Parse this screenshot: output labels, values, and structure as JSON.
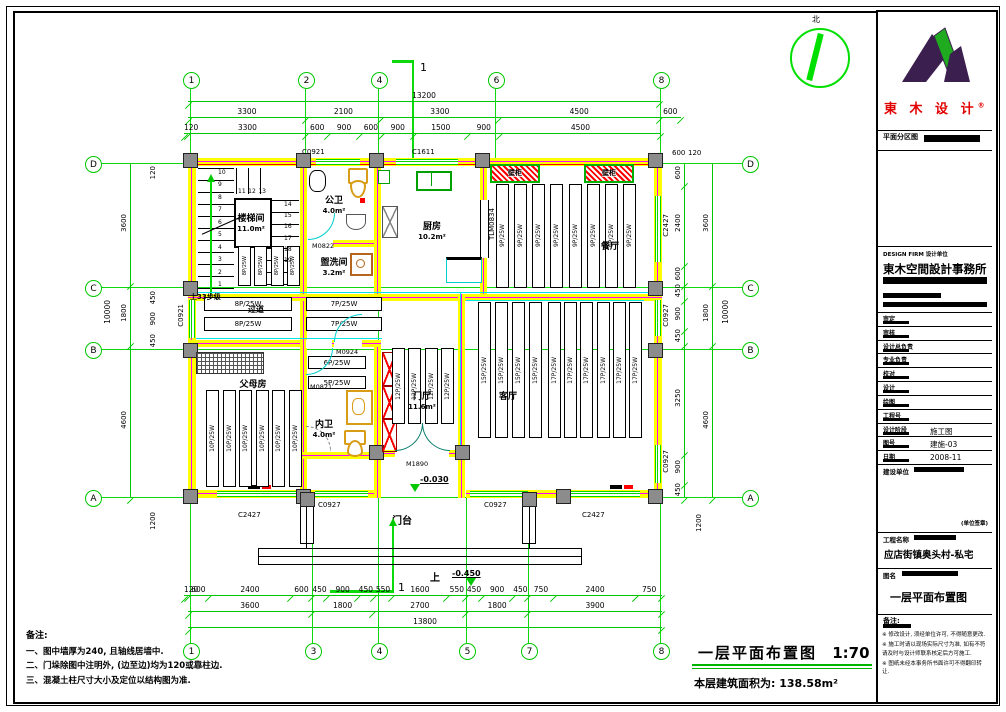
{
  "compass": {
    "north": "北"
  },
  "section": {
    "top": "1",
    "bottom": "1",
    "up": "上"
  },
  "grid": {
    "top": [
      "1",
      "2",
      "4",
      "6",
      "8"
    ],
    "bottom": [
      "1",
      "3",
      "4",
      "5",
      "7",
      "8"
    ],
    "left": [
      "D",
      "C",
      "B",
      "A"
    ],
    "right": [
      "D",
      "C",
      "B",
      "A"
    ]
  },
  "dims": {
    "top_total": "13200",
    "top_row2": [
      "3300",
      "2100",
      "3300",
      "4500",
      "600"
    ],
    "top_row3": [
      "120",
      "3300",
      "600",
      "900",
      "600",
      "900",
      "1500",
      "900",
      "4500"
    ],
    "bottom_row1": [
      "120",
      "600",
      "2400",
      "600",
      "450",
      "900",
      "450",
      "550",
      "1600",
      "550",
      "450",
      "900",
      "450",
      "750",
      "2400",
      "750"
    ],
    "bottom_row2": [
      "3600",
      "1800",
      "2700",
      "1800",
      "3900"
    ],
    "bottom_total": "13800",
    "left_total": "10000",
    "right_total": "10000",
    "left_mid": [
      "3600",
      "1800",
      "4600"
    ],
    "right_mid": [
      "3600",
      "1800",
      "4600"
    ],
    "right_inner": [
      "600",
      "2400",
      "600",
      "450",
      "900",
      "450",
      "3250",
      "900",
      "450"
    ],
    "left_top": "120",
    "left_e1": "450",
    "left_e2": "900",
    "left_e3": "450",
    "left_bottom": "1200",
    "right_top_a": "600",
    "right_top_b": "120",
    "right_bottom": "1200"
  },
  "rooms": {
    "stair": {
      "name": "楼梯间",
      "area": "11.0m²"
    },
    "pubwc": {
      "name": "公卫",
      "area": "4.0m²"
    },
    "laundry": {
      "name": "盥洗间",
      "area": "3.2m²"
    },
    "kitchen": {
      "name": "厨房",
      "area": "10.2m²"
    },
    "dining": {
      "name": "餐厅"
    },
    "hall": {
      "name": "过道"
    },
    "parents": {
      "name": "父母房"
    },
    "wc": {
      "name": "内卫",
      "area": "4.0m²"
    },
    "foyer": {
      "name": "门厅",
      "area": "11.6m²"
    },
    "living": {
      "name": "客厅"
    },
    "porch": {
      "name": "门台"
    }
  },
  "radiators": {
    "dining": [
      "9P/25W",
      "9P/25W",
      "9P/25W",
      "9P/25W",
      "9P/25W",
      "9P/25W",
      "9P/25W",
      "9P/25W"
    ],
    "stair": [
      "8P/25W",
      "8P/25W",
      "8P/25W",
      "8P/25W"
    ],
    "hall_left": [
      "8P/25W",
      "8P/25W"
    ],
    "hall_right": [
      "7P/25W",
      "7P/25W"
    ],
    "hall_mid_a": "6P/25W",
    "hall_mid_b": "5P/25W",
    "parents": [
      "10P/25W",
      "10P/25W",
      "10P/25W",
      "10P/25W",
      "10P/25W",
      "10P/25W"
    ],
    "foyer": [
      "12P/25W",
      "12P/25W",
      "12P/25W",
      "12P/25W"
    ],
    "living_a": [
      "15P/25W",
      "15P/25W",
      "15P/25W",
      "15P/25W"
    ],
    "living_b": [
      "17P/25W",
      "17P/25W",
      "17P/25W",
      "17P/25W",
      "17P/25W",
      "17P/25W"
    ]
  },
  "openings": {
    "c0921_top": "C0921",
    "c1611": "C1611",
    "c0921_left": "C0921",
    "c2427_r": "C2427",
    "c0927_r1": "C0927",
    "c0927_r2": "C0927",
    "c2427_b1": "C2427",
    "c0927_b1": "C0927",
    "c0927_b2": "C0927",
    "c2427_b2": "C2427",
    "m0822": "M0822",
    "m0821": "M0821",
    "m0924": "M0924",
    "m1890": "M1890",
    "tlm0834": "TLM0834",
    "cab1": "壁柜",
    "cab2": "壁柜"
  },
  "stairs": {
    "up_note": "上33步级",
    "left_nums": [
      "10",
      "9",
      "8",
      "7",
      "6",
      "5",
      "4",
      "3",
      "2",
      "1"
    ],
    "top_nums": [
      "11",
      "12",
      "13"
    ],
    "right_nums": [
      "14",
      "15",
      "16",
      "17",
      "18",
      "19"
    ]
  },
  "levels": {
    "entry": "-0.030",
    "porch": "-0.450"
  },
  "footer": {
    "title": "一层平面布置图",
    "scale": "1:70",
    "area_note": "本层建筑面积为: 138.58m²"
  },
  "notes": {
    "heading": "备注:",
    "items": [
      "一、图中墙厚为240, 且轴线居墙中.",
      "二、门垛除图中注明外, (边至边)均为120或靠柱边.",
      "三、混凝土柱尺寸大小及定位以结构图为准."
    ]
  },
  "titleblock": {
    "brand": "東 木 设 计",
    "brand_mark": "®",
    "zone_label": "平面分区图",
    "firm_en": "DESIGN FIRM 设计单位",
    "firm": "東木空間設計事務所",
    "rows": [
      {
        "label": "审定"
      },
      {
        "label": "审核"
      },
      {
        "label": "设计总负责"
      },
      {
        "label": "专业负责"
      },
      {
        "label": "校对"
      },
      {
        "label": "设计"
      },
      {
        "label": "绘图"
      },
      {
        "label": "工程号"
      },
      {
        "label": "设计阶段",
        "value": "施工图"
      },
      {
        "label": "图号",
        "value": "建施-03"
      },
      {
        "label": "日期",
        "value": "2008-11"
      }
    ],
    "client_label": "建设单位",
    "client_note": "(单位签章)",
    "project_label": "工程名称",
    "project": "应店街镇奥头村-私宅",
    "sheet_label": "图名",
    "sheet_name": "一层平面布置图",
    "remark_label": "备注:",
    "remarks": [
      "※ 修改设计, 须经单位许可, 不得随意更改.",
      "※ 施工时请以现场实际尺寸为准, 如有不符请及时与设计师联系核定后方可施工.",
      "※ 图纸未经本事务所书面许可不得翻印转让."
    ]
  }
}
